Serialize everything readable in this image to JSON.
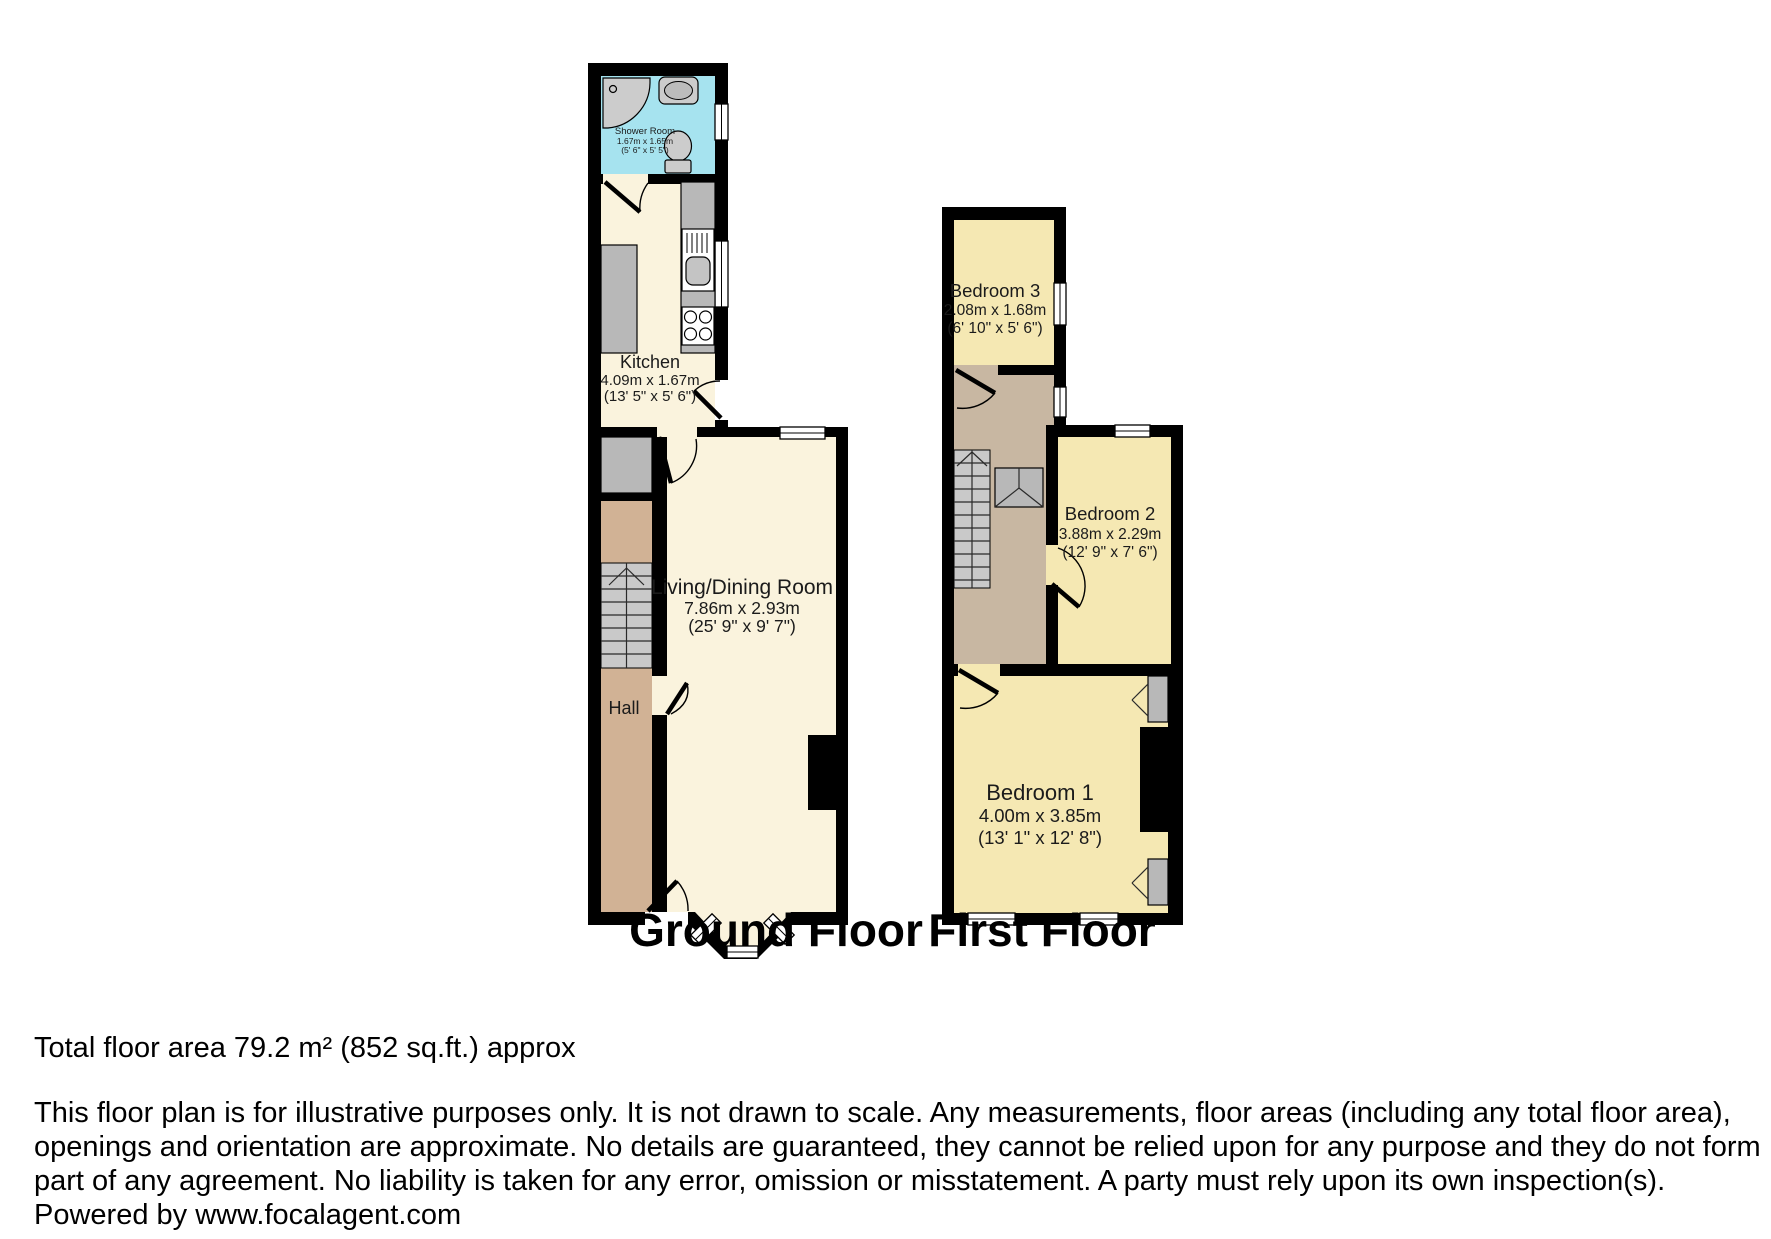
{
  "titles": {
    "ground_floor": "Ground Floor",
    "first_floor": "First Floor"
  },
  "rooms": {
    "shower": {
      "name": "Shower Room",
      "dims_m": "1.67m x 1.65m",
      "dims_ft": "(5' 6\" x 5' 5\")"
    },
    "kitchen": {
      "name": "Kitchen",
      "dims_m": "4.09m x 1.67m",
      "dims_ft": "(13' 5\" x 5' 6\")"
    },
    "living": {
      "name": "Living/Dining Room",
      "dims_m": "7.86m x 2.93m",
      "dims_ft": "(25' 9\" x 9' 7\")"
    },
    "hall": {
      "name": "Hall"
    },
    "bedroom3": {
      "name": "Bedroom 3",
      "dims_m": "2.08m x 1.68m",
      "dims_ft": "(6' 10\" x 5' 6\")"
    },
    "bedroom2": {
      "name": "Bedroom 2",
      "dims_m": "3.88m x 2.29m",
      "dims_ft": "(12' 9\" x 7' 6\")"
    },
    "bedroom1": {
      "name": "Bedroom 1",
      "dims_m": "4.00m x 3.85m",
      "dims_ft": "(13' 1\" x 12' 8\")"
    }
  },
  "footer": {
    "total_area": "Total floor area 79.2 m² (852 sq.ft.) approx",
    "disclaimer_lines": [
      "This floor plan is for illustrative purposes only. It is not drawn to scale. Any measurements, floor areas (including any total floor area),",
      "openings and orientation are approximate. No details are guaranteed, they cannot be relied upon for any purpose and they do not form",
      "part of any agreement. No liability is taken for any error, omission or misstatement. A party must rely upon its own inspection(s)."
    ],
    "powered_by": "Powered by www.focalagent.com"
  },
  "colors": {
    "wall": "#000000",
    "gf_room": "#faf3dd",
    "ff_room": "#f5e8b3",
    "shower_room": "#a6e3ef",
    "hall": "#d1b295",
    "landing": "#c8b7a2",
    "fixture_gray": "#b8b8b8",
    "stair_gray": "#c9c9c9"
  }
}
